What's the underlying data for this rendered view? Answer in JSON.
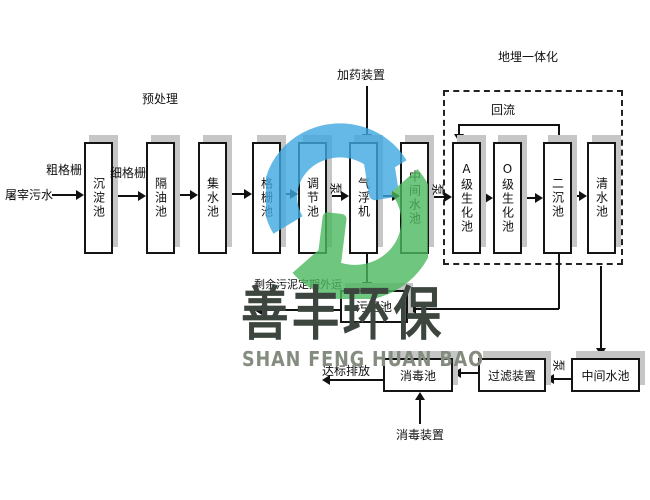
{
  "diagram": {
    "influent_label": "屠宰污水",
    "coarse_screen_label": "粗格栅",
    "fine_screen_label": "细格栅",
    "pretreatment_label": "预处理",
    "dosing_device_label": "加药装置",
    "buried_unit_label": "地埋一体化",
    "reflux_label": "回流",
    "pump_label": "泵",
    "sludge_note": "剩余污泥定期外运",
    "discharge_note": "达标排放",
    "disinfect_device_label": "消毒装置",
    "main_tanks": [
      {
        "label": "沉淀池"
      },
      {
        "label": "隔油池"
      },
      {
        "label": "集水池"
      },
      {
        "label": "格栅池"
      },
      {
        "label": "调节池"
      },
      {
        "label": "气浮机"
      },
      {
        "label": "中间水池"
      },
      {
        "label": "A级生化池"
      },
      {
        "label": "O级生化池"
      },
      {
        "label": "二沉池"
      },
      {
        "label": "清水池"
      }
    ],
    "sludge_tank_label": "污泥池",
    "disinfect_tank_label": "消毒池",
    "filter_device_label": "过滤装置",
    "intermediate_tank2_label": "中间水池"
  },
  "watermark": {
    "cn": "善丰环保",
    "en": "SHAN FENG HUAN BAO",
    "logo_blue": "#3fa8e0",
    "logo_green": "#4cb85f"
  }
}
